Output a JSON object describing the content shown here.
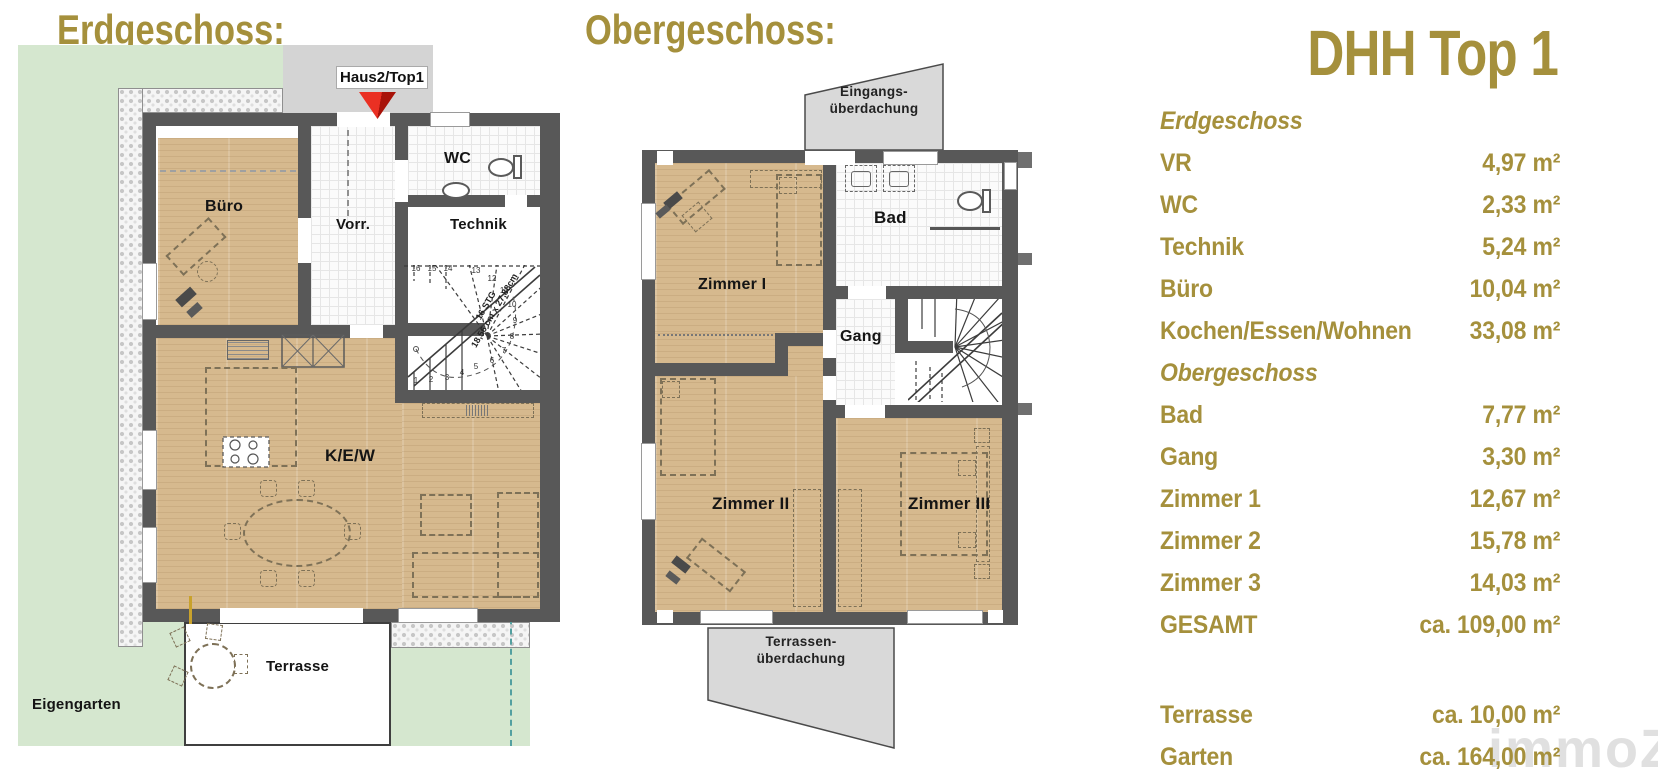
{
  "ground_floor": {
    "title": "Erdgeschoss:",
    "entrance_tag": "Haus2/Top1",
    "garden_label": "Eigengarten",
    "terrace_label": "Terrasse",
    "room_buero": "Büro",
    "room_vorraum": "Vorr.",
    "room_wc": "WC",
    "room_technik": "Technik",
    "room_kew": "K/E/W",
    "stair_label_line1": "16 STG",
    "stair_label_line2": "18,56 cm x 27,88cm",
    "stair_steps": [
      "1",
      "2",
      "3",
      "4",
      "5",
      "6",
      "7",
      "8",
      "9",
      "10",
      "11",
      "12",
      "13",
      "14",
      "15",
      "16"
    ]
  },
  "upper_floor": {
    "title": "Obergeschoss:",
    "canopy_entrance_line1": "Eingangs-",
    "canopy_entrance_line2": "überdachung",
    "canopy_terrace_line1": "Terrassen-",
    "canopy_terrace_line2": "überdachung",
    "room_zimmer1": "Zimmer I",
    "room_zimmer2": "Zimmer II",
    "room_zimmer3": "Zimmer III",
    "room_bad": "Bad",
    "room_gang": "Gang"
  },
  "summary": {
    "title": "DHH Top 1",
    "sections": [
      {
        "header": "Erdgeschoss",
        "rows": [
          {
            "label": "VR",
            "value": "4,97 m²"
          },
          {
            "label": "WC",
            "value": "2,33 m²"
          },
          {
            "label": "Technik",
            "value": "5,24 m²"
          },
          {
            "label": "Büro",
            "value": "10,04 m²"
          },
          {
            "label": "Kochen/Essen/Wohnen",
            "value": "33,08 m²"
          }
        ]
      },
      {
        "header": "Obergeschoss",
        "rows": [
          {
            "label": "Bad",
            "value": "7,77 m²"
          },
          {
            "label": "Gang",
            "value": "3,30 m²"
          },
          {
            "label": "Zimmer 1",
            "value": "12,67 m²"
          },
          {
            "label": "Zimmer 2",
            "value": "15,78 m²"
          },
          {
            "label": "Zimmer 3",
            "value": "14,03 m²"
          },
          {
            "label": "GESAMT",
            "value": "ca. 109,00 m²"
          }
        ]
      }
    ],
    "footer_rows": [
      {
        "label": "Terrasse",
        "value": "ca. 10,00 m²"
      },
      {
        "label": "Garten",
        "value": "ca. 164,00 m²"
      }
    ]
  },
  "watermark": "immoZ",
  "colors": {
    "gold": "#a5903c",
    "wall": "#585858",
    "wood": "#d6b98e",
    "garden_green": "#d5e7cf",
    "canopy_gray": "#d9d9d9",
    "arrow_red": "#d92320",
    "boundary_teal": "#53a0a0"
  }
}
